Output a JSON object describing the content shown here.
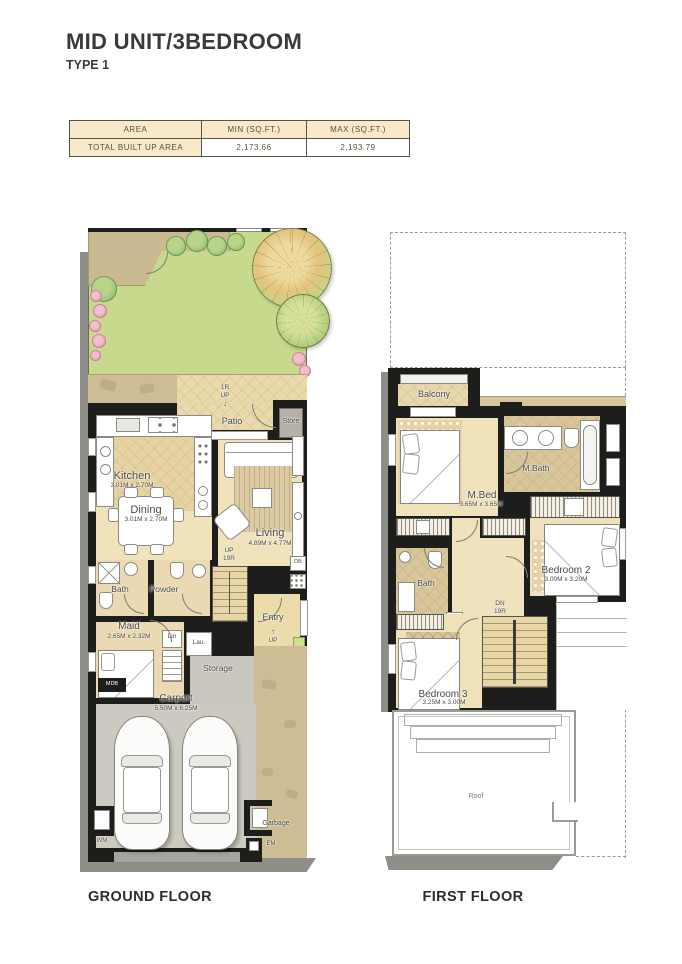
{
  "header": {
    "title": "MID UNIT/3BEDROOM",
    "subtitle": "TYPE 1"
  },
  "table": {
    "col_area": "AREA",
    "col_min": "MIN (SQ.FT.)",
    "col_max": "MAX (SQ.FT.)",
    "row_label": "TOTAL BUILT UP AREA",
    "min_value": "2,173.66",
    "max_value": "2,193.79"
  },
  "ground": {
    "caption": "GROUND FLOOR",
    "patio": "Patio",
    "patio_riser": "1R",
    "patio_up": "UP",
    "store": "Store",
    "kitchen": "Kitchen",
    "kitchen_dims": "3.01M x 2.70M",
    "dining": "Dining",
    "dining_dims": "3.01M x 2.70M",
    "living": "Living",
    "living_dims": "4.89M x 4.77M",
    "stairs_up": "UP",
    "stairs_risers": "19R",
    "bath": "Bath",
    "powder": "Powder",
    "maid": "Maid",
    "maid_dims": "2.65M x 2.32M",
    "linen": "Lin",
    "laundry": "Lau.",
    "storage": "Storage",
    "entry": "Entry",
    "entry_up": "UP",
    "carport": "Carport",
    "carport_dims": "5.50M x 6.25M",
    "wm": "WM",
    "mdb": "MDB",
    "db": "DB",
    "garbage": "Garbage",
    "em": "EM"
  },
  "first": {
    "caption": "FIRST FLOOR",
    "balcony": "Balcony",
    "master_bed": "M.Bed",
    "master_bed_dims": "3.65M x 3.65M",
    "master_bath": "M.Bath",
    "bedroom2": "Bedroom 2",
    "bedroom2_dims": "3.00M x 3.20M",
    "bath": "Bath",
    "stairs_dn": "DN",
    "stairs_risers": "19R",
    "db": "DB",
    "bedroom3": "Bedroom 3",
    "bedroom3_dims": "3.25M x 3.00M",
    "roof": "Roof"
  },
  "icons": {
    "up_arrow": "↑",
    "down_arrow": "↓"
  },
  "palette": {
    "wall": "#1d1d1b",
    "floor_beige": "#efe1ba",
    "tile_tan": "#d9c59a",
    "grass_green": "#c7d98d",
    "paving_tan": "#cdbc94",
    "carport_grey": "#ccc9c0",
    "table_header_beige": "#f8e9c9"
  }
}
